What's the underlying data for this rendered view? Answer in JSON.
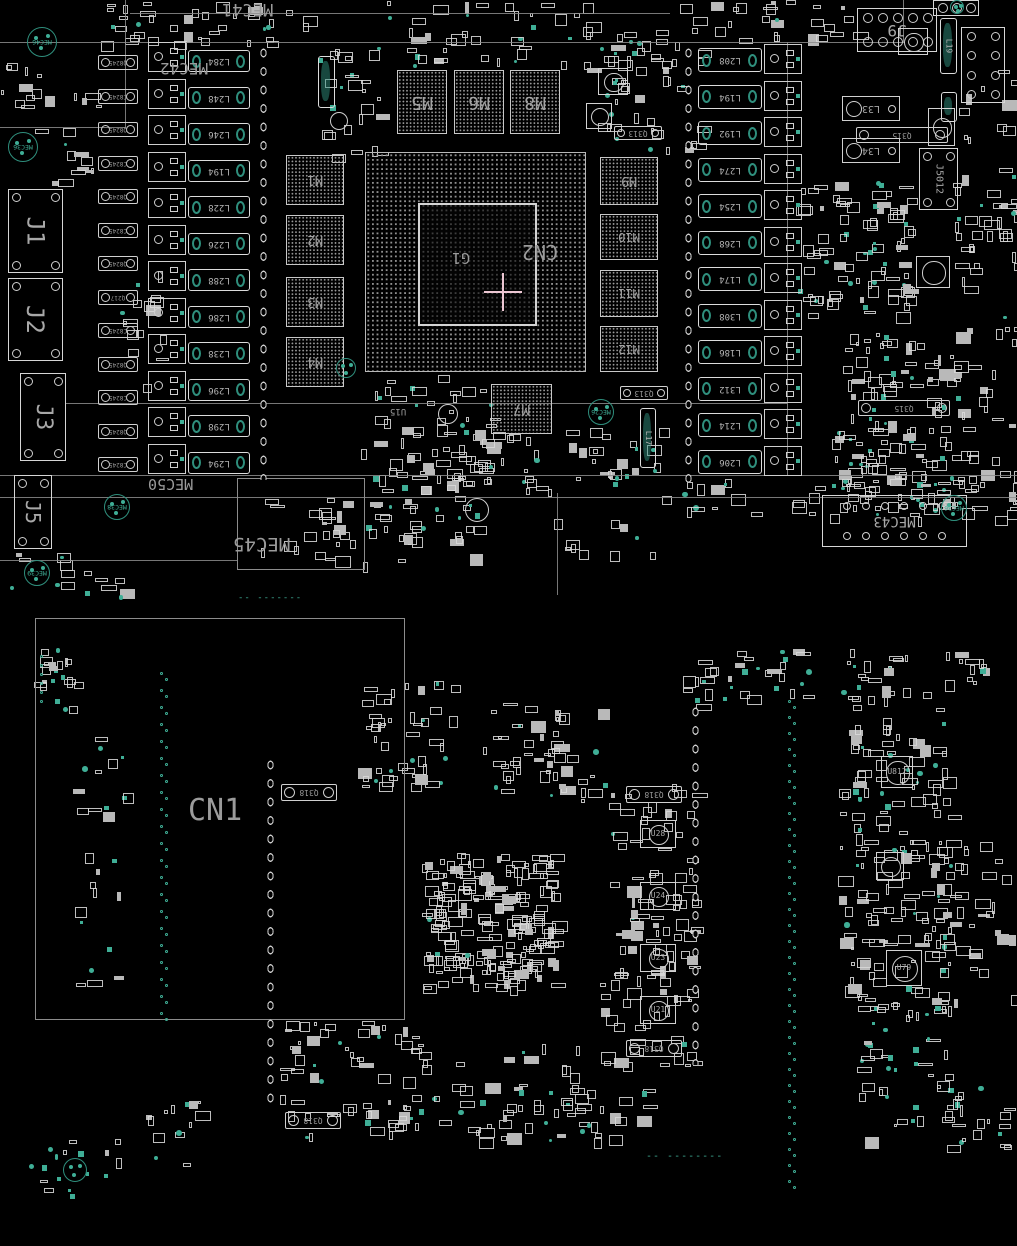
{
  "colors": {
    "background": "#000000",
    "silkscreen": "#d4d4d4",
    "silkscreen_dim": "#9a9a9a",
    "pad_teal": "#2f8f7d",
    "pad_teal_bright": "#3fae96",
    "ref_label_grey": "#969696",
    "crosshair_pink": "#ecc6d2",
    "outline_line": "#8c8c8c",
    "bga_dot": "#8f8f8f"
  },
  "silk_lines": [
    {
      "x": 0,
      "y": 42,
      "len": 905,
      "dir": "h"
    },
    {
      "x": 130,
      "y": 13,
      "len": 540,
      "dir": "h"
    },
    {
      "x": 125,
      "y": 0,
      "len": 128,
      "dir": "v"
    },
    {
      "x": 0,
      "y": 127,
      "len": 126,
      "dir": "h"
    },
    {
      "x": 65,
      "y": 403,
      "len": 722,
      "dir": "h"
    },
    {
      "x": 0,
      "y": 475,
      "len": 1017,
      "dir": "h"
    },
    {
      "x": 0,
      "y": 497,
      "len": 1017,
      "dir": "h"
    },
    {
      "x": 787,
      "y": 42,
      "len": 433,
      "dir": "v"
    },
    {
      "x": 0,
      "y": 560,
      "len": 238,
      "dir": "h"
    },
    {
      "x": 557,
      "y": 493,
      "len": 102,
      "dir": "v"
    },
    {
      "x": 903,
      "y": 0,
      "len": 42,
      "dir": "v"
    }
  ],
  "outline_rects": [
    {
      "name": "cn1-region",
      "x": 35,
      "y": 618,
      "w": 370,
      "h": 402
    },
    {
      "name": "mec45-box",
      "x": 237,
      "y": 478,
      "w": 128,
      "h": 92
    }
  ],
  "pad_strips": [
    {
      "x": 256,
      "y": 44,
      "h": 436
    },
    {
      "x": 681,
      "y": 44,
      "h": 438
    },
    {
      "x": 263,
      "y": 756,
      "h": 350
    },
    {
      "x": 688,
      "y": 703,
      "h": 362
    }
  ],
  "cap_columns": [
    {
      "x": 98,
      "y0": 55,
      "step": 33.5,
      "n": 13,
      "w": 40,
      "h": 15,
      "labels": [
        "Q8245",
        "C8245",
        "Q8245",
        "C8245",
        "Q8245",
        "C8245",
        "Q8245",
        "Q217",
        "C8245",
        "Q8245",
        "C8245",
        "Q8245",
        "C8245"
      ]
    }
  ],
  "part_caps": [
    {
      "label": "Q313",
      "x": 614,
      "y": 126,
      "w": 48,
      "h": 14
    },
    {
      "label": "Q313",
      "x": 620,
      "y": 386,
      "w": 48,
      "h": 14
    },
    {
      "label": "Q315",
      "x": 856,
      "y": 127,
      "w": 92,
      "h": 16
    },
    {
      "label": "Q315",
      "x": 858,
      "y": 400,
      "w": 92,
      "h": 16
    },
    {
      "label": "Q318",
      "x": 281,
      "y": 784,
      "w": 56,
      "h": 17
    },
    {
      "label": "Q318",
      "x": 626,
      "y": 786,
      "w": 56,
      "h": 17
    },
    {
      "label": "Q318",
      "x": 626,
      "y": 1040,
      "w": 56,
      "h": 17
    },
    {
      "label": "Q318",
      "x": 285,
      "y": 1112,
      "w": 56,
      "h": 17
    }
  ],
  "coils": [
    {
      "label": "L33",
      "x": 842,
      "y": 96,
      "w": 58,
      "h": 25
    },
    {
      "label": "L34",
      "x": 842,
      "y": 138,
      "w": 58,
      "h": 25
    }
  ],
  "driver_columns": [
    {
      "x": 148,
      "y0": 42,
      "step": 36.5,
      "n": 12
    },
    {
      "x": 764,
      "y0": 44,
      "step": 36.5,
      "n": 12
    }
  ],
  "inductor_columns": [
    {
      "x": 188,
      "y0": 50,
      "step": 36.5,
      "n": 12,
      "w": 62,
      "h": 22,
      "labels": [
        "L284",
        "L248",
        "L246",
        "L194",
        "L228",
        "L226",
        "L288",
        "L286",
        "L238",
        "L296",
        "L298",
        "L294"
      ]
    },
    {
      "x": 698,
      "y0": 48,
      "step": 36.5,
      "n": 12,
      "w": 64,
      "h": 24,
      "labels": [
        "L208",
        "L194",
        "L192",
        "L274",
        "L254",
        "L268",
        "L174",
        "L308",
        "L186",
        "L312",
        "L214",
        "L206"
      ]
    }
  ],
  "v_inductors": [
    {
      "label": "L19",
      "x": 940,
      "y": 18,
      "w": 17,
      "h": 56
    },
    {
      "label": "",
      "x": 941,
      "y": 92,
      "w": 16,
      "h": 30
    },
    {
      "label": "",
      "x": 318,
      "y": 56,
      "w": 17,
      "h": 52
    },
    {
      "label": "L17",
      "x": 640,
      "y": 408,
      "w": 16,
      "h": 60
    }
  ],
  "memories": [
    {
      "label": "M1",
      "x": 286,
      "y": 155,
      "w": 58,
      "h": 50,
      "fs": 13
    },
    {
      "label": "M2",
      "x": 286,
      "y": 215,
      "w": 58,
      "h": 50,
      "fs": 13
    },
    {
      "label": "M3",
      "x": 286,
      "y": 277,
      "w": 58,
      "h": 50,
      "fs": 13
    },
    {
      "label": "M4",
      "x": 286,
      "y": 337,
      "w": 58,
      "h": 50,
      "fs": 13
    },
    {
      "label": "M5",
      "x": 397,
      "y": 70,
      "w": 50,
      "h": 64,
      "fs": 18
    },
    {
      "label": "M6",
      "x": 454,
      "y": 70,
      "w": 50,
      "h": 64,
      "fs": 18
    },
    {
      "label": "M8",
      "x": 510,
      "y": 70,
      "w": 50,
      "h": 64,
      "fs": 18
    },
    {
      "label": "M9",
      "x": 600,
      "y": 157,
      "w": 58,
      "h": 48,
      "fs": 13
    },
    {
      "label": "M10",
      "x": 600,
      "y": 214,
      "w": 58,
      "h": 46,
      "fs": 12
    },
    {
      "label": "M11",
      "x": 600,
      "y": 270,
      "w": 58,
      "h": 47,
      "fs": 12
    },
    {
      "label": "M12",
      "x": 600,
      "y": 326,
      "w": 58,
      "h": 46,
      "fs": 12
    },
    {
      "label": "M7",
      "x": 491,
      "y": 384,
      "w": 61,
      "h": 50,
      "fs": 14
    }
  ],
  "gpu": {
    "x": 365,
    "y": 152,
    "w": 221,
    "h": 220,
    "die": {
      "x": 418,
      "y": 203,
      "w": 119,
      "h": 123
    },
    "die_label": "G1",
    "socket_label": "CN2",
    "die_label_pos": {
      "x": 452,
      "y": 250,
      "fs": 15
    },
    "socket_label_pos": {
      "x": 522,
      "y": 242,
      "fs": 20
    },
    "crosshair": {
      "cx": 503,
      "cy": 292,
      "arm": 19
    }
  },
  "connectors": [
    {
      "label": "J1",
      "x": 8,
      "y": 189,
      "w": 55,
      "h": 84,
      "rot": 90,
      "fs": 24,
      "pads": "corners"
    },
    {
      "label": "J2",
      "x": 8,
      "y": 278,
      "w": 55,
      "h": 83,
      "rot": 90,
      "fs": 24,
      "pads": "corners"
    },
    {
      "label": "J3",
      "x": 20,
      "y": 373,
      "w": 46,
      "h": 88,
      "rot": 90,
      "fs": 22,
      "pads": "corners"
    },
    {
      "label": "J5",
      "x": 14,
      "y": 475,
      "w": 38,
      "h": 74,
      "rot": 90,
      "fs": 20,
      "pads": "corners"
    },
    {
      "label": "J9",
      "x": 857,
      "y": 8,
      "w": 80,
      "h": 44,
      "rot": 180,
      "fs": 16,
      "pads": "grid2x5"
    },
    {
      "label": "J5012",
      "x": 919,
      "y": 148,
      "w": 39,
      "h": 62,
      "rot": 90,
      "fs": 10,
      "pads": "corners"
    },
    {
      "label": "",
      "x": 961,
      "y": 27,
      "w": 44,
      "h": 76,
      "rot": 0,
      "fs": 0,
      "pads": "grid4x2"
    },
    {
      "label": "",
      "x": 933,
      "y": 0,
      "w": 46,
      "h": 16,
      "rot": 0,
      "fs": 0,
      "pads": "row3"
    },
    {
      "label": "MEC43",
      "x": 822,
      "y": 495,
      "w": 145,
      "h": 52,
      "rot": 180,
      "fs": 14,
      "pads": "grid2x6"
    }
  ],
  "u_chips": [
    {
      "label": "U812",
      "x": 881,
      "y": 756,
      "w": 32,
      "h": 32
    },
    {
      "label": "",
      "x": 876,
      "y": 852,
      "w": 28,
      "h": 28
    },
    {
      "label": "U79",
      "x": 886,
      "y": 950,
      "w": 36,
      "h": 36
    },
    {
      "label": "U28",
      "x": 640,
      "y": 820,
      "w": 36,
      "h": 28
    },
    {
      "label": "U24",
      "x": 640,
      "y": 882,
      "w": 36,
      "h": 28
    },
    {
      "label": "U23",
      "x": 640,
      "y": 944,
      "w": 36,
      "h": 28
    },
    {
      "label": "U21",
      "x": 640,
      "y": 996,
      "w": 36,
      "h": 28
    },
    {
      "label": "",
      "x": 898,
      "y": 28,
      "w": 30,
      "h": 27
    },
    {
      "label": "",
      "x": 598,
      "y": 68,
      "w": 30,
      "h": 27
    },
    {
      "label": "",
      "x": 586,
      "y": 103,
      "w": 26,
      "h": 26
    },
    {
      "label": "",
      "x": 928,
      "y": 108,
      "w": 27,
      "h": 38
    },
    {
      "label": "",
      "x": 916,
      "y": 256,
      "w": 34,
      "h": 32
    }
  ],
  "mec_marks": [
    {
      "label": "MEC46",
      "x": 27,
      "y": 27,
      "d": 30
    },
    {
      "label": "MEC36",
      "x": 8,
      "y": 132,
      "d": 30
    },
    {
      "label": "MEC38",
      "x": 104,
      "y": 494,
      "d": 26
    },
    {
      "label": "MEC26",
      "x": 588,
      "y": 399,
      "d": 26
    },
    {
      "label": "MEC36",
      "x": 941,
      "y": 495,
      "d": 26
    },
    {
      "label": "MEC39",
      "x": 24,
      "y": 560,
      "d": 26
    },
    {
      "label": "",
      "x": 63,
      "y": 1158,
      "d": 24
    },
    {
      "label": "",
      "x": 950,
      "y": 0,
      "d": 14
    },
    {
      "label": "",
      "x": 336,
      "y": 358,
      "d": 20
    }
  ],
  "labels": [
    {
      "text": "MEC41",
      "x": 222,
      "y": 0,
      "fs": 17,
      "rot": 180
    },
    {
      "text": "MEC42",
      "x": 160,
      "y": 60,
      "fs": 16,
      "rot": 180
    },
    {
      "text": "MEC50",
      "x": 148,
      "y": 476,
      "fs": 15,
      "rot": 180
    },
    {
      "text": "MEC45",
      "x": 233,
      "y": 534,
      "fs": 19,
      "rot": 180
    },
    {
      "text": "CN1",
      "x": 188,
      "y": 796,
      "fs": 30,
      "rot": 0
    },
    {
      "text": "U15",
      "x": 390,
      "y": 406,
      "fs": 9,
      "rot": 180
    }
  ],
  "dashes": [
    {
      "text": "-- -------",
      "x": 238,
      "y": 594,
      "color": "#3fae96",
      "fs": 9
    },
    {
      "text": "-- --------",
      "x": 646,
      "y": 1152,
      "color": "#3fae96",
      "fs": 10
    }
  ],
  "circles": [
    {
      "x": 465,
      "y": 498,
      "d": 24
    },
    {
      "x": 438,
      "y": 404,
      "d": 20
    },
    {
      "x": 330,
      "y": 112,
      "d": 18
    }
  ],
  "dot_trails": [
    {
      "x": 160,
      "y0": 672,
      "y1": 1012,
      "step": 17,
      "pair": true
    },
    {
      "x": 788,
      "y0": 700,
      "y1": 1185,
      "step": 16,
      "pair": true
    },
    {
      "x": 40,
      "y0": 655,
      "y1": 703,
      "step": 9,
      "pair": false
    }
  ],
  "clusters": [
    {
      "name": "top-left-strip",
      "x": 100,
      "y": 0,
      "w": 250,
      "h": 42,
      "n": 40,
      "seed": 101,
      "teal": 0.15
    },
    {
      "name": "top-mid-strip",
      "x": 380,
      "y": 0,
      "w": 300,
      "h": 40,
      "n": 34,
      "seed": 102,
      "teal": 0.2
    },
    {
      "name": "top-right-strip",
      "x": 690,
      "y": 0,
      "w": 170,
      "h": 40,
      "n": 26,
      "seed": 103,
      "teal": 0.12
    },
    {
      "name": "top-caps-row",
      "x": 395,
      "y": 44,
      "w": 270,
      "h": 24,
      "n": 22,
      "seed": 104,
      "teal": 0.15
    },
    {
      "name": "above-m5",
      "x": 316,
      "y": 45,
      "w": 66,
      "h": 110,
      "n": 26,
      "seed": 105,
      "teal": 0.2
    },
    {
      "name": "m8-right",
      "x": 585,
      "y": 40,
      "w": 115,
      "h": 110,
      "n": 40,
      "seed": 106,
      "teal": 0.18
    },
    {
      "name": "right-mid",
      "x": 795,
      "y": 178,
      "w": 115,
      "h": 135,
      "n": 90,
      "seed": 107,
      "teal": 0.18
    },
    {
      "name": "right-low",
      "x": 832,
      "y": 330,
      "w": 120,
      "h": 148,
      "n": 80,
      "seed": 108,
      "teal": 0.15
    },
    {
      "name": "right-vrm",
      "x": 838,
      "y": 425,
      "w": 120,
      "h": 88,
      "n": 48,
      "seed": 109,
      "teal": 0.12
    },
    {
      "name": "right-edge-upper",
      "x": 953,
      "y": 55,
      "w": 62,
      "h": 250,
      "n": 46,
      "seed": 110,
      "teal": 0.12
    },
    {
      "name": "right-edge-lower",
      "x": 953,
      "y": 310,
      "w": 62,
      "h": 200,
      "n": 40,
      "seed": 111,
      "teal": 0.1
    },
    {
      "name": "below-gpu",
      "x": 360,
      "y": 375,
      "w": 135,
      "h": 108,
      "n": 60,
      "seed": 112,
      "teal": 0.12
    },
    {
      "name": "m7-side",
      "x": 560,
      "y": 425,
      "w": 100,
      "h": 60,
      "n": 25,
      "seed": 113,
      "teal": 0.2
    },
    {
      "name": "mid-col-low",
      "x": 420,
      "y": 430,
      "w": 130,
      "h": 60,
      "n": 30,
      "seed": 114,
      "teal": 0.1
    },
    {
      "name": "mec45-area",
      "x": 300,
      "y": 480,
      "w": 185,
      "h": 62,
      "n": 34,
      "seed": 115,
      "teal": 0.1
    },
    {
      "name": "sep-area",
      "x": 250,
      "y": 498,
      "w": 230,
      "h": 64,
      "n": 26,
      "seed": 116,
      "teal": 0.12
    },
    {
      "name": "sep-mid",
      "x": 540,
      "y": 515,
      "w": 110,
      "h": 40,
      "n": 10,
      "seed": 117,
      "teal": 0.15
    },
    {
      "name": "tophalf-bottom-strip",
      "x": 660,
      "y": 478,
      "w": 355,
      "h": 40,
      "n": 46,
      "seed": 118,
      "teal": 0.14
    },
    {
      "name": "bottom-left-corner-top",
      "x": 0,
      "y": 552,
      "w": 120,
      "h": 45,
      "n": 16,
      "seed": 119,
      "teal": 0.25
    },
    {
      "name": "j2-side",
      "x": 120,
      "y": 270,
      "w": 40,
      "h": 120,
      "n": 16,
      "seed": 120,
      "teal": 0.1
    },
    {
      "name": "left-col",
      "x": 50,
      "y": 85,
      "w": 48,
      "h": 100,
      "n": 15,
      "seed": 121,
      "teal": 0.12
    },
    {
      "name": "left-edge-mid",
      "x": 0,
      "y": 60,
      "w": 45,
      "h": 70,
      "n": 12,
      "seed": 122,
      "teal": 0.2
    },
    {
      "name": "bh-tl",
      "x": 33,
      "y": 648,
      "w": 42,
      "h": 62,
      "n": 22,
      "seed": 123,
      "teal": 0.3
    },
    {
      "name": "bh-top1",
      "x": 358,
      "y": 678,
      "w": 95,
      "h": 112,
      "n": 48,
      "seed": 124,
      "teal": 0.18
    },
    {
      "name": "bh-top2",
      "x": 480,
      "y": 700,
      "w": 120,
      "h": 100,
      "n": 52,
      "seed": 125,
      "teal": 0.15
    },
    {
      "name": "bh-gpu-back",
      "x": 420,
      "y": 853,
      "w": 134,
      "h": 133,
      "n": 210,
      "seed": 126,
      "teal": 0.02
    },
    {
      "name": "bh-u2-col",
      "x": 600,
      "y": 780,
      "w": 95,
      "h": 285,
      "n": 110,
      "seed": 127,
      "teal": 0.06
    },
    {
      "name": "bh-r1",
      "x": 838,
      "y": 688,
      "w": 112,
      "h": 160,
      "n": 80,
      "seed": 128,
      "teal": 0.18
    },
    {
      "name": "bh-r2",
      "x": 838,
      "y": 845,
      "w": 112,
      "h": 168,
      "n": 88,
      "seed": 129,
      "teal": 0.18
    },
    {
      "name": "bh-redge",
      "x": 925,
      "y": 840,
      "w": 88,
      "h": 168,
      "n": 38,
      "seed": 130,
      "teal": 0.1
    },
    {
      "name": "bh-below-cn1a",
      "x": 278,
      "y": 1020,
      "w": 142,
      "h": 118,
      "n": 60,
      "seed": 131,
      "teal": 0.12
    },
    {
      "name": "bh-below-cn1b",
      "x": 395,
      "y": 1040,
      "w": 185,
      "h": 100,
      "n": 50,
      "seed": 132,
      "teal": 0.12
    },
    {
      "name": "bh-bottom-mid",
      "x": 540,
      "y": 1080,
      "w": 120,
      "h": 60,
      "n": 24,
      "seed": 133,
      "teal": 0.15
    },
    {
      "name": "bh-bottom-right",
      "x": 858,
      "y": 1078,
      "w": 150,
      "h": 68,
      "n": 36,
      "seed": 134,
      "teal": 0.2
    },
    {
      "name": "bh-bottom-left",
      "x": 28,
      "y": 1138,
      "w": 100,
      "h": 58,
      "n": 18,
      "seed": 135,
      "teal": 0.4
    },
    {
      "name": "bh-tr1",
      "x": 678,
      "y": 648,
      "w": 72,
      "h": 56,
      "n": 20,
      "seed": 136,
      "teal": 0.2
    },
    {
      "name": "bh-tr2",
      "x": 843,
      "y": 648,
      "w": 62,
      "h": 52,
      "n": 18,
      "seed": 137,
      "teal": 0.15
    },
    {
      "name": "bh-tr3",
      "x": 938,
      "y": 648,
      "w": 48,
      "h": 40,
      "n": 12,
      "seed": 138,
      "teal": 0.2
    },
    {
      "name": "bh-tr-green",
      "x": 753,
      "y": 648,
      "w": 60,
      "h": 50,
      "n": 14,
      "seed": 139,
      "teal": 0.6
    },
    {
      "name": "bh-left-inner",
      "x": 70,
      "y": 720,
      "w": 55,
      "h": 270,
      "n": 26,
      "seed": 140,
      "teal": 0.35
    },
    {
      "name": "bh-left-lower",
      "x": 138,
      "y": 1088,
      "w": 60,
      "h": 85,
      "n": 14,
      "seed": 141,
      "teal": 0.3
    },
    {
      "name": "bh-green-mid",
      "x": 848,
      "y": 1005,
      "w": 100,
      "h": 70,
      "n": 30,
      "seed": 142,
      "teal": 0.6
    }
  ]
}
